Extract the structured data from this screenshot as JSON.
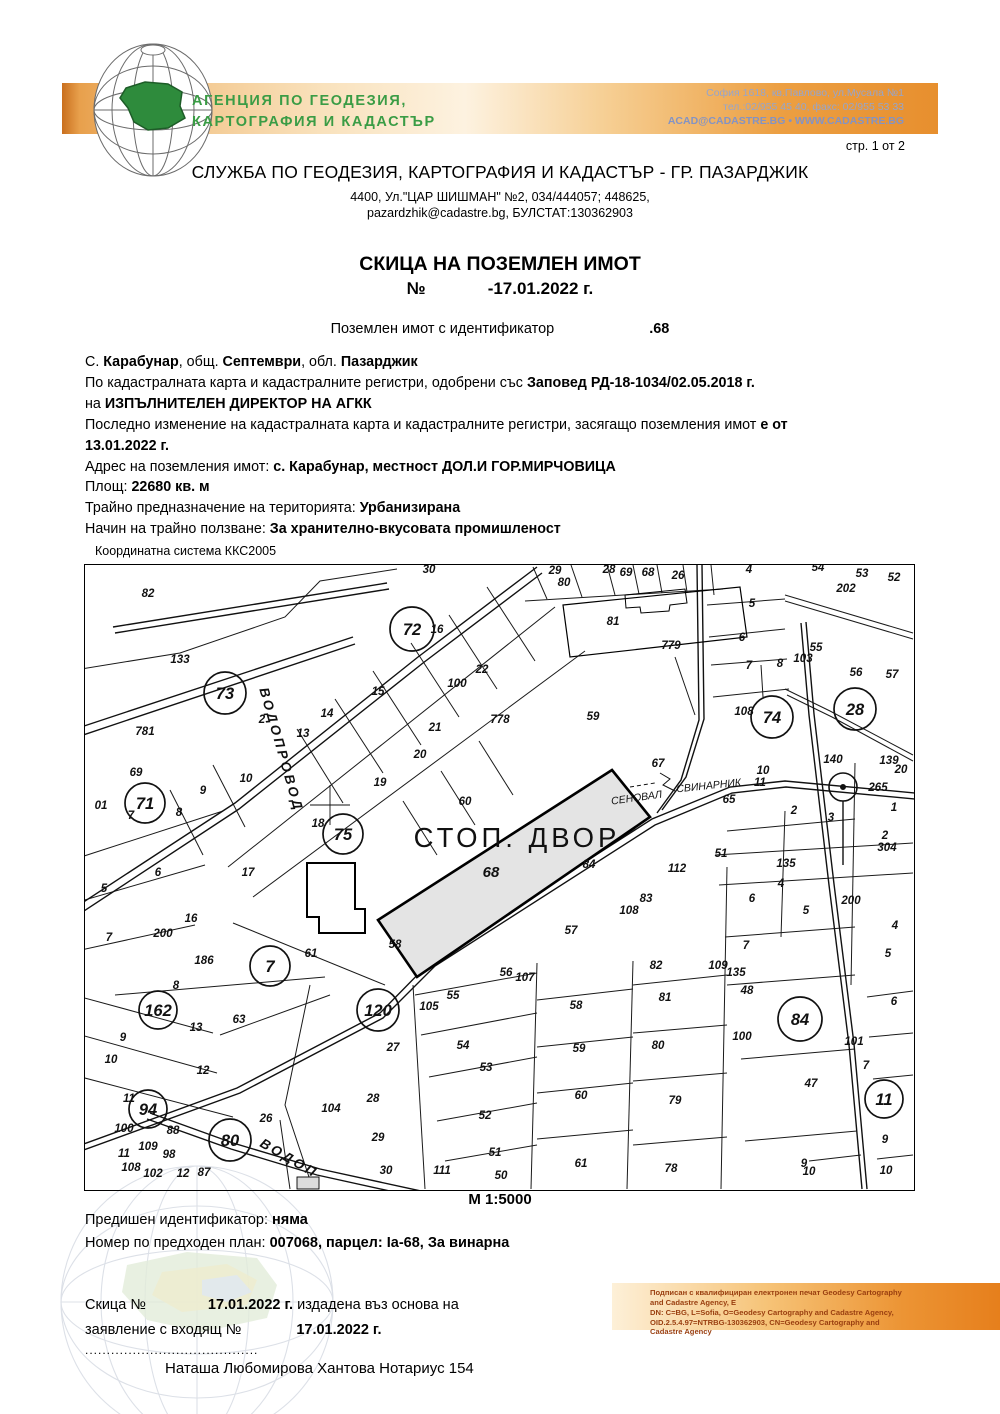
{
  "banner": {
    "agency_line1": "АГЕНЦИЯ ПО ГЕОДЕЗИЯ,",
    "agency_line2": "КАРТОГРАФИЯ И КАДАСТЪР",
    "contact_line1": "София 1618, кв.Павлово, ул.Мусала №1",
    "contact_line2": "тел.:02/955 45 40, факс: 02/955 53 33",
    "contact_line3": "ACAD@CADASTRE.BG • WWW.CADASTRE.BG",
    "band_color_left": "#c96f1e",
    "band_color_right": "#e78f2e",
    "agency_green": "#3a9c45"
  },
  "page_number": "стр. 1 от 2",
  "service": {
    "title": "СЛУЖБА ПО ГЕОДЕЗИЯ, КАРТОГРАФИЯ И КАДАСТЪР - ГР. ПАЗАРДЖИК",
    "address1": "4400, Ул.\"ЦАР ШИШМАН\" №2, 034/444057; 448625,",
    "address2": "pazardzhik@cadastre.bg, БУЛСТАТ:130362903"
  },
  "document": {
    "title": "СКИЦА НА ПОЗЕМЛЕН ИМОТ",
    "number_label": "№",
    "date": "-17.01.2022 г.",
    "ident_label": "Поземлен имот с идентификатор",
    "ident_value": ".68"
  },
  "property_lines": [
    [
      {
        "t": "С. "
      },
      {
        "t": "Карабунар",
        "b": 1
      },
      {
        "t": ", общ. "
      },
      {
        "t": "Септември",
        "b": 1
      },
      {
        "t": ", обл. "
      },
      {
        "t": "Пазарджик",
        "b": 1
      }
    ],
    [
      {
        "t": "По кадастралната карта и кадастралните регистри, одобрени със "
      },
      {
        "t": "Заповед РД-18-1034/02.05.2018 г.",
        "b": 1
      }
    ],
    [
      {
        "t": "на "
      },
      {
        "t": "ИЗПЪЛНИТЕЛЕН ДИРЕКТОР НА АГКК",
        "b": 1
      }
    ],
    [
      {
        "t": "Последно изменение на кадастралната карта и кадастралните регистри, засягащо поземления имот "
      },
      {
        "t": "е от",
        "b": 1
      }
    ],
    [
      {
        "t": "13.01.2022 г.",
        "b": 1
      }
    ],
    [
      {
        "t": "Адрес на поземления имот: "
      },
      {
        "t": "с. Карабунар, местност ДОЛ.И ГОР.МИРЧОВИЦА",
        "b": 1
      }
    ],
    [
      {
        "t": "Площ: "
      },
      {
        "t": "22680 кв. м",
        "b": 1
      }
    ],
    [
      {
        "t": "Трайно предназначение на територията: "
      },
      {
        "t": "Урбанизирана",
        "b": 1
      }
    ],
    [
      {
        "t": "Начин на трайно ползване: "
      },
      {
        "t": "За хранително-вкусовата промишленост",
        "b": 1
      }
    ]
  ],
  "map": {
    "coord_system": "Координатна система ККС2005",
    "scale": "М 1:5000",
    "highlight_fill": "#e4e4e4",
    "labels": [
      {
        "k": "c",
        "t": "72",
        "x": 327,
        "y": 64,
        "r": 22
      },
      {
        "k": "c",
        "t": "73",
        "x": 140,
        "y": 128,
        "r": 21
      },
      {
        "k": "c",
        "t": "71",
        "x": 60,
        "y": 238,
        "r": 20
      },
      {
        "k": "c",
        "t": "75",
        "x": 258,
        "y": 269,
        "r": 20
      },
      {
        "k": "c",
        "t": "74",
        "x": 687,
        "y": 152,
        "r": 21
      },
      {
        "k": "c",
        "t": "28",
        "x": 770,
        "y": 144,
        "r": 21
      },
      {
        "k": "c",
        "t": "7",
        "x": 185,
        "y": 401,
        "r": 20
      },
      {
        "k": "c",
        "t": "120",
        "x": 293,
        "y": 445,
        "r": 21
      },
      {
        "k": "c",
        "t": "162",
        "x": 73,
        "y": 445,
        "r": 19
      },
      {
        "k": "c",
        "t": "94",
        "x": 63,
        "y": 544,
        "r": 19
      },
      {
        "k": "c",
        "t": "80",
        "x": 145,
        "y": 575,
        "r": 21
      },
      {
        "k": "c",
        "t": "84",
        "x": 715,
        "y": 454,
        "r": 22
      },
      {
        "k": "c",
        "t": "11",
        "x": 799,
        "y": 534,
        "r": 19
      },
      {
        "k": "g",
        "t": "СТОП. ДВОР",
        "x": 432,
        "y": 282
      },
      {
        "k": "s",
        "t": "68",
        "x": 406,
        "y": 312
      },
      {
        "k": "r",
        "t": "ВОДОПРОВОД",
        "x": 192,
        "y": 186,
        "a": 74
      },
      {
        "k": "r",
        "t": "ВОДОП",
        "x": 202,
        "y": 597,
        "a": 30
      },
      {
        "k": "t",
        "t": "СЕНОВАЛ",
        "x": 552,
        "y": 236,
        "a": -8
      },
      {
        "k": "t",
        "t": "СВИНАРНИК",
        "x": 624,
        "y": 224,
        "a": -6
      },
      {
        "t": "82",
        "x": 63,
        "y": 32
      },
      {
        "t": "133",
        "x": 95,
        "y": 98
      },
      {
        "t": "781",
        "x": 60,
        "y": 170
      },
      {
        "t": "2",
        "x": 177,
        "y": 158
      },
      {
        "t": "16",
        "x": 352,
        "y": 68
      },
      {
        "t": "15",
        "x": 293,
        "y": 130
      },
      {
        "t": "14",
        "x": 242,
        "y": 152
      },
      {
        "t": "13",
        "x": 218,
        "y": 172
      },
      {
        "t": "21",
        "x": 350,
        "y": 166
      },
      {
        "t": "20",
        "x": 335,
        "y": 193
      },
      {
        "t": "19",
        "x": 295,
        "y": 221
      },
      {
        "t": "22",
        "x": 397,
        "y": 108
      },
      {
        "t": "778",
        "x": 415,
        "y": 158
      },
      {
        "t": "100",
        "x": 372,
        "y": 122
      },
      {
        "t": "60",
        "x": 380,
        "y": 240
      },
      {
        "t": "30",
        "x": 344,
        "y": 8
      },
      {
        "t": "29",
        "x": 470,
        "y": 9
      },
      {
        "t": "80",
        "x": 479,
        "y": 21
      },
      {
        "t": "28",
        "x": 524,
        "y": 8
      },
      {
        "t": "69",
        "x": 541,
        "y": 11
      },
      {
        "t": "68",
        "x": 563,
        "y": 11
      },
      {
        "t": "26",
        "x": 593,
        "y": 14
      },
      {
        "t": "4",
        "x": 664,
        "y": 8
      },
      {
        "t": "54",
        "x": 733,
        "y": 6
      },
      {
        "t": "53",
        "x": 777,
        "y": 12
      },
      {
        "t": "52",
        "x": 809,
        "y": 16
      },
      {
        "t": "202",
        "x": 761,
        "y": 27
      },
      {
        "t": "81",
        "x": 528,
        "y": 60
      },
      {
        "t": "779",
        "x": 586,
        "y": 84
      },
      {
        "t": "5",
        "x": 667,
        "y": 42
      },
      {
        "t": "6",
        "x": 657,
        "y": 76
      },
      {
        "t": "7",
        "x": 664,
        "y": 104
      },
      {
        "t": "8",
        "x": 695,
        "y": 102
      },
      {
        "t": "103",
        "x": 718,
        "y": 97
      },
      {
        "t": "55",
        "x": 731,
        "y": 86
      },
      {
        "t": "56",
        "x": 771,
        "y": 111
      },
      {
        "t": "57",
        "x": 807,
        "y": 113
      },
      {
        "t": "59",
        "x": 508,
        "y": 155
      },
      {
        "t": "67",
        "x": 573,
        "y": 202
      },
      {
        "t": "65",
        "x": 644,
        "y": 238
      },
      {
        "t": "140",
        "x": 748,
        "y": 198
      },
      {
        "t": "139",
        "x": 804,
        "y": 199
      },
      {
        "t": "20",
        "x": 816,
        "y": 208
      },
      {
        "t": "265",
        "x": 793,
        "y": 226
      },
      {
        "t": "10",
        "x": 678,
        "y": 209
      },
      {
        "t": "11",
        "x": 675,
        "y": 221
      },
      {
        "t": "1",
        "x": 809,
        "y": 246
      },
      {
        "t": "2",
        "x": 709,
        "y": 249
      },
      {
        "t": "3",
        "x": 746,
        "y": 256
      },
      {
        "t": "51",
        "x": 636,
        "y": 292
      },
      {
        "t": "135",
        "x": 701,
        "y": 302
      },
      {
        "t": "2",
        "x": 800,
        "y": 274
      },
      {
        "t": "304",
        "x": 802,
        "y": 286
      },
      {
        "t": "4",
        "x": 696,
        "y": 322
      },
      {
        "t": "6",
        "x": 667,
        "y": 337
      },
      {
        "t": "5",
        "x": 721,
        "y": 349
      },
      {
        "t": "200",
        "x": 766,
        "y": 339
      },
      {
        "t": "4",
        "x": 810,
        "y": 364
      },
      {
        "t": "5",
        "x": 803,
        "y": 392
      },
      {
        "t": "7",
        "x": 661,
        "y": 384
      },
      {
        "t": "109",
        "x": 633,
        "y": 404
      },
      {
        "t": "135",
        "x": 651,
        "y": 411
      },
      {
        "t": "48",
        "x": 662,
        "y": 429
      },
      {
        "t": "112",
        "x": 592,
        "y": 307
      },
      {
        "t": "83",
        "x": 561,
        "y": 337
      },
      {
        "t": "108",
        "x": 544,
        "y": 349
      },
      {
        "t": "84",
        "x": 504,
        "y": 303
      },
      {
        "t": "57",
        "x": 486,
        "y": 369
      },
      {
        "t": "82",
        "x": 571,
        "y": 404
      },
      {
        "t": "58",
        "x": 310,
        "y": 383
      },
      {
        "t": "56",
        "x": 421,
        "y": 411
      },
      {
        "t": "107",
        "x": 440,
        "y": 416
      },
      {
        "t": "58",
        "x": 491,
        "y": 444
      },
      {
        "t": "59",
        "x": 494,
        "y": 487
      },
      {
        "t": "60",
        "x": 496,
        "y": 534
      },
      {
        "t": "61",
        "x": 496,
        "y": 602
      },
      {
        "t": "81",
        "x": 580,
        "y": 436
      },
      {
        "t": "80",
        "x": 573,
        "y": 484
      },
      {
        "t": "79",
        "x": 590,
        "y": 539
      },
      {
        "t": "78",
        "x": 586,
        "y": 607
      },
      {
        "t": "55",
        "x": 368,
        "y": 434
      },
      {
        "t": "105",
        "x": 344,
        "y": 445
      },
      {
        "t": "54",
        "x": 378,
        "y": 484
      },
      {
        "t": "53",
        "x": 401,
        "y": 506
      },
      {
        "t": "52",
        "x": 400,
        "y": 554
      },
      {
        "t": "51",
        "x": 410,
        "y": 591
      },
      {
        "t": "50",
        "x": 416,
        "y": 614
      },
      {
        "t": "111",
        "x": 357,
        "y": 609
      },
      {
        "t": "63",
        "x": 154,
        "y": 458
      },
      {
        "t": "13",
        "x": 111,
        "y": 466
      },
      {
        "t": "9",
        "x": 38,
        "y": 476
      },
      {
        "t": "10",
        "x": 26,
        "y": 498
      },
      {
        "t": "12",
        "x": 118,
        "y": 509
      },
      {
        "t": "11",
        "x": 44,
        "y": 537
      },
      {
        "t": "27",
        "x": 308,
        "y": 486
      },
      {
        "t": "28",
        "x": 288,
        "y": 537
      },
      {
        "t": "104",
        "x": 246,
        "y": 547
      },
      {
        "t": "26",
        "x": 181,
        "y": 557
      },
      {
        "t": "29",
        "x": 293,
        "y": 576
      },
      {
        "t": "30",
        "x": 301,
        "y": 609
      },
      {
        "t": "88",
        "x": 88,
        "y": 569
      },
      {
        "t": "100",
        "x": 39,
        "y": 567
      },
      {
        "t": "109",
        "x": 63,
        "y": 585
      },
      {
        "t": "98",
        "x": 84,
        "y": 593
      },
      {
        "t": "11",
        "x": 39,
        "y": 592
      },
      {
        "t": "108",
        "x": 46,
        "y": 606
      },
      {
        "t": "102",
        "x": 68,
        "y": 612
      },
      {
        "t": "12",
        "x": 98,
        "y": 612
      },
      {
        "t": "87",
        "x": 119,
        "y": 611
      },
      {
        "t": "8",
        "x": 91,
        "y": 424
      },
      {
        "t": "69",
        "x": 51,
        "y": 211
      },
      {
        "t": "01",
        "x": 16,
        "y": 244
      },
      {
        "t": "7",
        "x": 46,
        "y": 254
      },
      {
        "t": "8",
        "x": 94,
        "y": 251
      },
      {
        "t": "9",
        "x": 118,
        "y": 229
      },
      {
        "t": "10",
        "x": 161,
        "y": 217
      },
      {
        "t": "17",
        "x": 163,
        "y": 311
      },
      {
        "t": "6",
        "x": 73,
        "y": 311
      },
      {
        "t": "5",
        "x": 19,
        "y": 327
      },
      {
        "t": "16",
        "x": 106,
        "y": 357
      },
      {
        "t": "200",
        "x": 78,
        "y": 372
      },
      {
        "t": "7",
        "x": 24,
        "y": 376
      },
      {
        "t": "18",
        "x": 233,
        "y": 262
      },
      {
        "t": "61",
        "x": 226,
        "y": 392
      },
      {
        "t": "186",
        "x": 119,
        "y": 399
      },
      {
        "t": "108",
        "x": 659,
        "y": 150
      },
      {
        "t": "100",
        "x": 657,
        "y": 475
      },
      {
        "t": "47",
        "x": 726,
        "y": 522
      },
      {
        "t": "101",
        "x": 769,
        "y": 480
      },
      {
        "t": "7",
        "x": 781,
        "y": 504
      },
      {
        "t": "6",
        "x": 809,
        "y": 440
      },
      {
        "t": "9",
        "x": 800,
        "y": 578
      },
      {
        "t": "10",
        "x": 801,
        "y": 609
      },
      {
        "t": "9",
        "x": 719,
        "y": 602
      },
      {
        "t": "10",
        "x": 724,
        "y": 610
      }
    ]
  },
  "bottom_lines": {
    "prev_ident": [
      {
        "t": "Предишен идентификатор: "
      },
      {
        "t": "няма",
        "b": 1
      }
    ],
    "prev_plan": [
      {
        "t": "Номер по предходен план: "
      },
      {
        "t": "007068, парцел: Iа-68, За винарна",
        "b": 1
      }
    ],
    "sketch_line1": [
      {
        "t": "Скица №"
      },
      {
        "g": 62
      },
      {
        "t": "17.01.2022 г.",
        "b": 1
      },
      {
        "t": " издадена въз основа на"
      }
    ],
    "sketch_line2": [
      {
        "t": "заявление с входящ №"
      },
      {
        "g": 55
      },
      {
        "t": "17.01.2022 г.",
        "b": 1
      }
    ],
    "dots": "........................................",
    "notary": "Наташа Любомирова Хантова Нотариус 154"
  },
  "signature": {
    "lines": [
      "Подписан с квалифициран електронен печат Geodesy Cartography",
      "and Cadastre Agency, Е",
      "DN: C=BG, L=Sofia, O=Geodesy Cartography and Cadastre Agency,",
      "OID.2.5.4.97=NTRBG-130362903, CN=Geodesy Cartography and",
      "Cadastre Agency"
    ]
  }
}
